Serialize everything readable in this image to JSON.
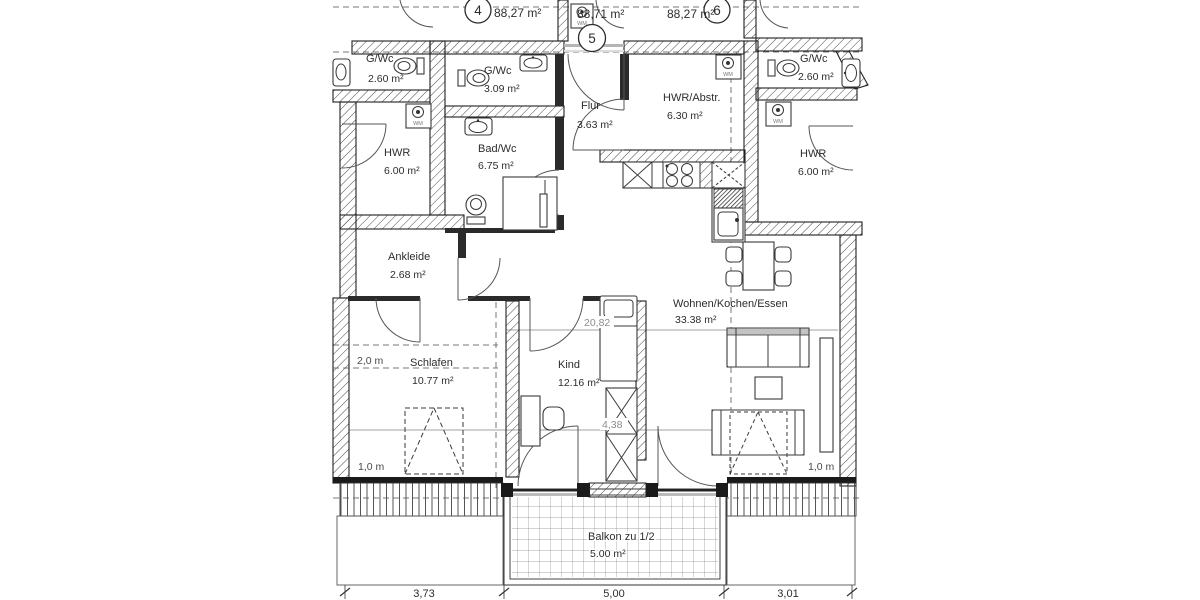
{
  "drawing": {
    "type": "apartment-floor-plan"
  },
  "units": [
    {
      "number": "4",
      "area": "88,27 m²"
    },
    {
      "number": "5",
      "area": "88,71 m²"
    },
    {
      "number": "6",
      "area": "88,27 m²"
    }
  ],
  "rooms": {
    "left_gwc": {
      "name": "G/Wc",
      "area": "2.60 m²"
    },
    "left_hwr": {
      "name": "HWR",
      "area": "6.00 m²"
    },
    "gwc": {
      "name": "G/Wc",
      "area": "3.09 m²"
    },
    "flur": {
      "name": "Flur",
      "area": "3.63 m²"
    },
    "hwr_abstr": {
      "name": "HWR/Abstr.",
      "area": "6.30 m²"
    },
    "bad": {
      "name": "Bad/Wc",
      "area": "6.75 m²"
    },
    "ankleide": {
      "name": "Ankleide",
      "area": "2.68 m²"
    },
    "schlafen": {
      "name": "Schlafen",
      "area": "10.77 m²"
    },
    "kind": {
      "name": "Kind",
      "area": "12.16 m²"
    },
    "wohnen": {
      "name": "Wohnen/Kochen/Essen",
      "area": "33.38 m²"
    },
    "balkon": {
      "name": "Balkon zu 1/2",
      "area": "5.00 m²"
    },
    "right_gwc": {
      "name": "G/Wc",
      "area": "2.60 m²"
    },
    "right_hwr": {
      "name": "HWR",
      "area": "6.00 m²"
    }
  },
  "annotations": {
    "height_2m": "2,0 m",
    "height_1m": "1,0 m",
    "level_20": "20,82",
    "level_4": "4,38",
    "wm": "WM"
  },
  "dimensions": {
    "left": "3,73",
    "center": "5,00",
    "right": "3,01"
  }
}
